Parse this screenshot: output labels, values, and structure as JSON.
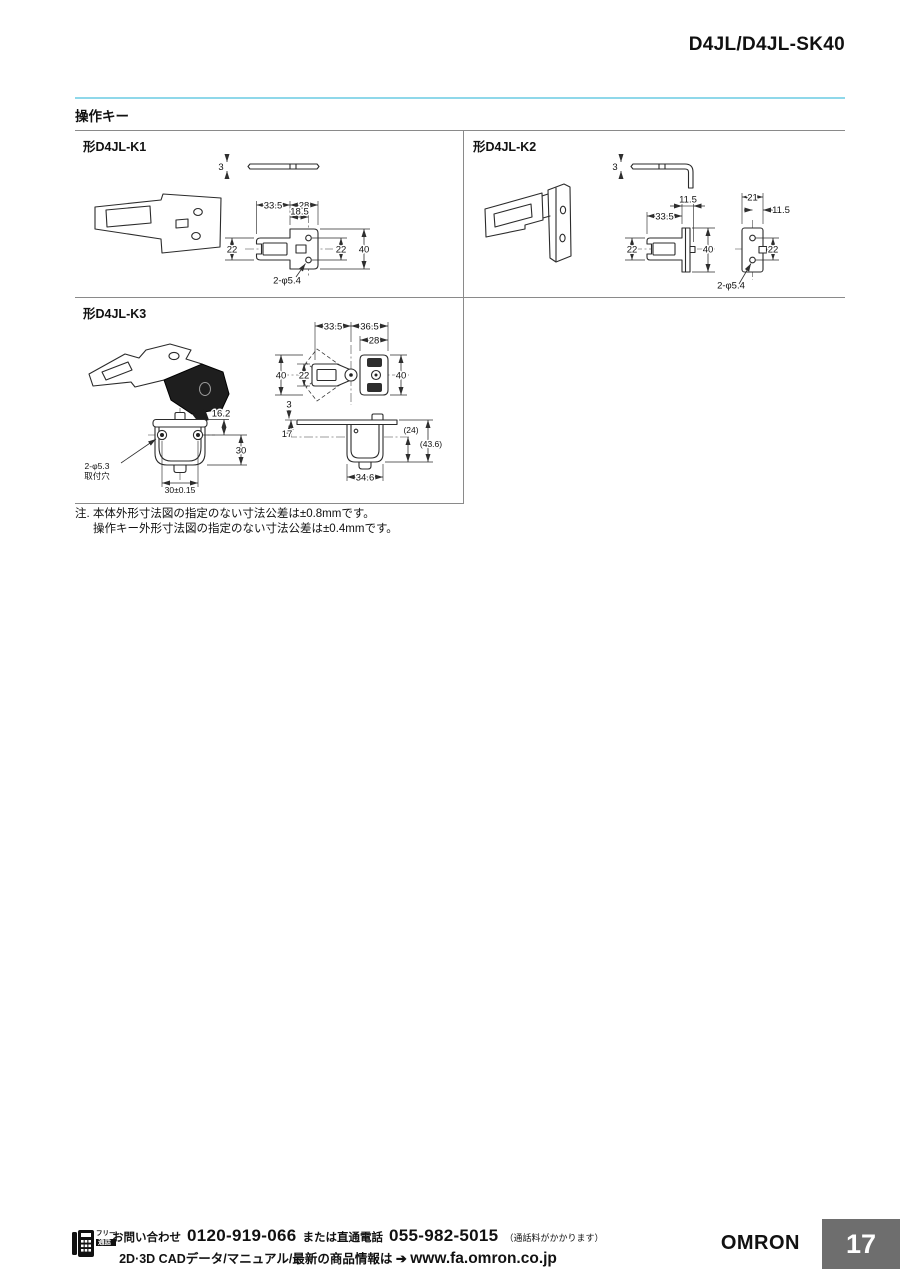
{
  "page": {
    "title": "D4JL/D4JL-SK40",
    "section_title": "操作キー",
    "note_line1": "注. 本体外形寸法図の指定のない寸法公差は±0.8mmです。",
    "note_line2": "操作キー外形寸法図の指定のない寸法公差は±0.4mmです。",
    "page_number": "17",
    "brand": "OMRON"
  },
  "colors": {
    "accent_rule": "#8fd8ea",
    "page_number_box": "#6e6e6e",
    "table_border": "#8a8a8a"
  },
  "footer": {
    "free_call_top": "フリー",
    "free_call_bottom": "通話",
    "contact_label": "お問い合わせ",
    "phone_free": "0120-919-066",
    "direct_label": "または直通電話",
    "phone_direct": "055-982-5015",
    "phone_note": "（通話料がかかります）",
    "cad_text": "2D·3D CADデータ/マニュアル/最新の商品情報は",
    "arrow": "➔",
    "url": "www.fa.omron.co.jp"
  },
  "drawings": {
    "k1": {
      "label": "形D4JL-K1",
      "thickness": "3",
      "dim_335": "33.5",
      "dim_28": "28",
      "dim_185": "18.5",
      "dim_22_left": "22",
      "dim_22_right": "22",
      "dim_40": "40",
      "dim_holes": "2-φ5.4"
    },
    "k2": {
      "label": "形D4JL-K2",
      "thickness": "3",
      "dim_335": "33.5",
      "dim_115_top": "11.5",
      "dim_22_left": "22",
      "dim_40": "40",
      "dim_21": "21",
      "dim_115_right": "11.5",
      "dim_22_right": "22",
      "dim_holes": "2-φ5.4"
    },
    "k3": {
      "label": "形D4JL-K3",
      "dim_335": "33.5",
      "dim_365": "36.5",
      "dim_28": "28",
      "dim_40_left": "40",
      "dim_22": "22",
      "dim_40_right": "40",
      "dim_162": "16.2",
      "dim_30": "30",
      "dim_holes_1": "2-φ5.3",
      "dim_holes_2": "取付穴",
      "dim_30t": "30±0.15",
      "thickness": "3",
      "dim_17": "17",
      "dim_24": "(24)",
      "dim_436": "(43.6)",
      "dim_346": "34.6"
    }
  }
}
